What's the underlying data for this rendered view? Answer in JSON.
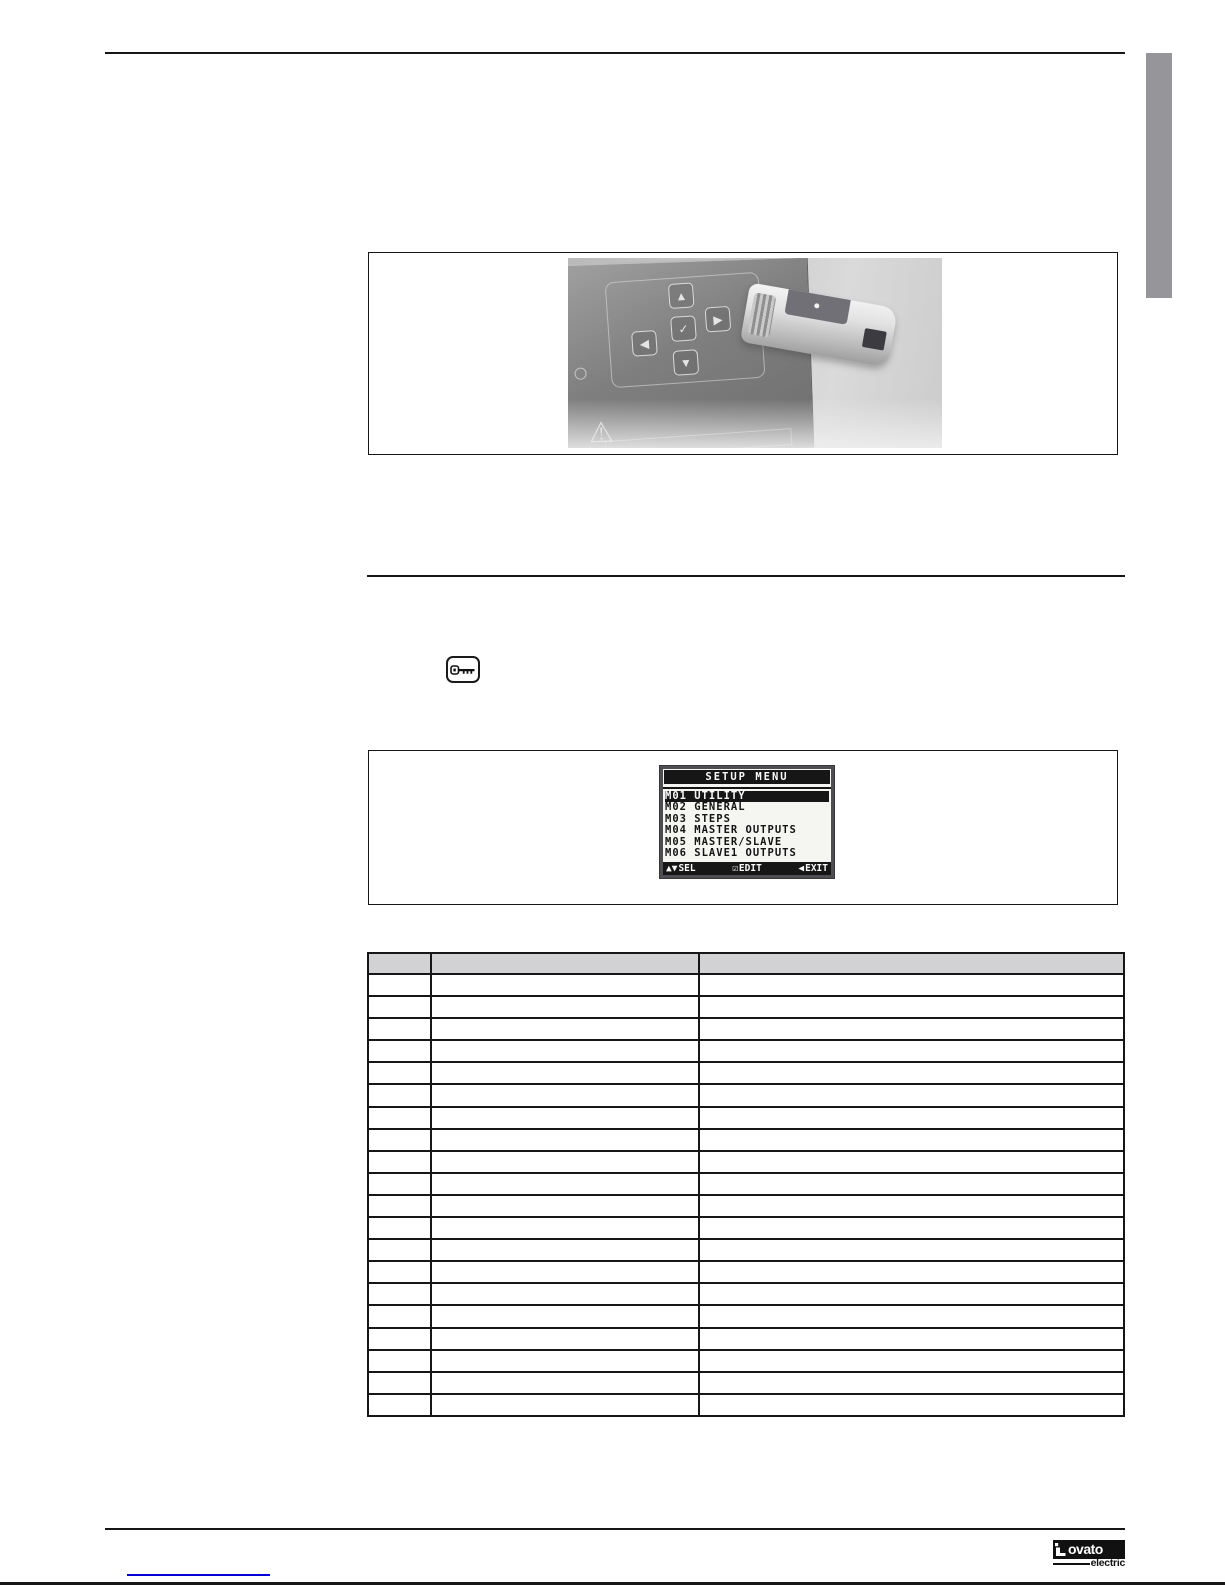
{
  "lcd": {
    "title": "SETUP MENU",
    "items": [
      "M01 UTILITY",
      "M02 GENERAL",
      "M03 STEPS",
      "M04 MASTER OUTPUTS",
      "M05 MASTER/SLAVE",
      "M06 SLAVE1 OUTPUTS"
    ],
    "selected_index": 0,
    "legend": [
      {
        "icon": "▲▼",
        "label": "SEL"
      },
      {
        "icon": "☑",
        "label": "EDIT"
      },
      {
        "icon": "◀",
        "label": "EXIT"
      }
    ]
  },
  "photo": {
    "keypad_buttons": [
      "▲",
      "◀",
      "✓",
      "▶",
      "▼"
    ],
    "warning_icon": "⚠"
  },
  "table": {
    "columns": [
      "",
      "",
      ""
    ],
    "row_count": 20,
    "rows_are_empty": true
  },
  "logo": {
    "brand": "ovato",
    "sub": "electric"
  },
  "colors": {
    "side_tab_gray": "#95959a",
    "table_header_gray": "#d2d2d4",
    "link_blue": "#0000d4",
    "lcd_frame": "#4d4d52",
    "lcd_ink": "#161616",
    "rule_black": "#161616"
  }
}
